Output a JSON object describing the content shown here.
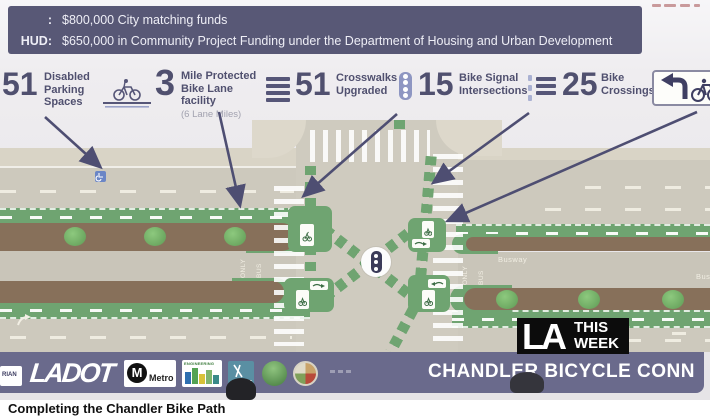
{
  "banner": {
    "line1_label": ":",
    "line1_text": "$800,000 City matching funds",
    "line2_label": "HUD:",
    "line2_text": "$650,000 in Community Project Funding under the Department of Housing and Urban Development"
  },
  "stats": {
    "items": [
      {
        "value": "51",
        "label": "Disabled Parking Spaces",
        "icon": "wheelchair-parking"
      },
      {
        "value": "3",
        "label": "Mile Protected Bike Lane facility",
        "sublabel": "(6 Lane Miles)",
        "icon": "protected-bike-lane"
      },
      {
        "value": "51",
        "label": "Crosswalks Upgraded",
        "icon": "crosswalk-lines"
      },
      {
        "value": "15",
        "label": "Bike Signal Intersections",
        "icon": "bike-signal"
      },
      {
        "value": "25",
        "label": "Bike Crossings",
        "icon": "bike-crossing-lines"
      }
    ],
    "turn_sign_icon": "left-turn-with-bike-sign"
  },
  "diagram": {
    "labels": {
      "busway": "Busway",
      "only": "ONLY",
      "bus": "BUS"
    },
    "colors": {
      "bike_lane_green": "#6fa471",
      "median_brown": "#87705a",
      "road_gray": "#cdc9bd",
      "arrow_navy": "#4e4e72",
      "parking_sign_blue": "#6b86c6"
    }
  },
  "la_this_week": {
    "big": "LA",
    "top": "THIS",
    "bottom": "WEEK"
  },
  "footer": {
    "partial_logo": "RIAN",
    "ladot": "LADOT",
    "metro_m": "M",
    "metro": "Metro",
    "engineering": "ENGINEERING",
    "light": "LIGHT",
    "title": "CHANDLER BICYCLE CONN"
  },
  "caption": {
    "text": "Completing the Chandler Bike Path"
  },
  "colors": {
    "banner_bg": "#585876",
    "footer_bg": "#6a6a8c",
    "stat_text": "#50506f"
  }
}
